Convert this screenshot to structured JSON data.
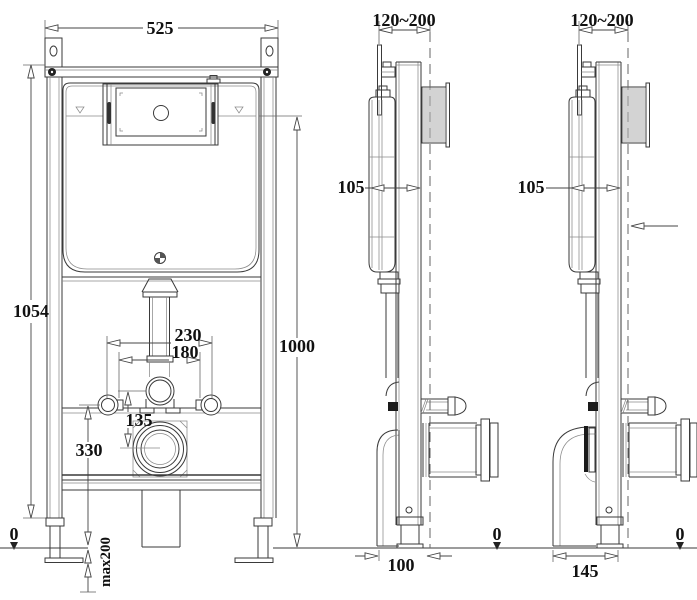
{
  "drawing": {
    "front_view": {
      "width": "525",
      "height_total": "1054",
      "height_flush_axis": "1000",
      "fixing_spacing_outer": "230",
      "fixing_spacing_inner": "180",
      "connector_offset": "135",
      "outlet_height": "330",
      "floor_ref": "0",
      "leg_extension": "max200"
    },
    "side_view_floor_outlet": {
      "depth_range": "120~200",
      "frame_depth": "105",
      "front_to_wall": "100",
      "floor_ref": "0"
    },
    "side_view_wall_outlet": {
      "depth_range": "120~200",
      "frame_depth": "105",
      "outlet_offset": "145",
      "floor_ref": "0"
    }
  }
}
